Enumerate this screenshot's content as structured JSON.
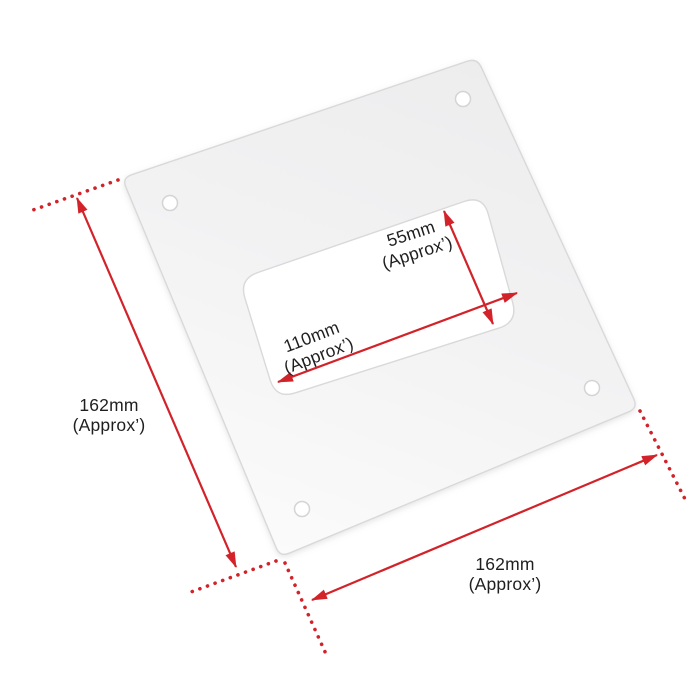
{
  "colors": {
    "accent_red": "#d2232a",
    "label_text": "#1f1f1f",
    "background": "#ffffff",
    "plate_light": "#fbfbfb",
    "plate_dark": "#ededee",
    "plate_edge": "#d9d9da"
  },
  "dims": {
    "outer_height": {
      "value": "162mm",
      "qualifier": "(Approx’)"
    },
    "outer_width": {
      "value": "162mm",
      "qualifier": "(Approx’)"
    },
    "cutout_width": {
      "value": "110mm",
      "qualifier": "(Approx’)"
    },
    "cutout_height": {
      "value": "55mm",
      "qualifier": "(Approx’)"
    }
  }
}
